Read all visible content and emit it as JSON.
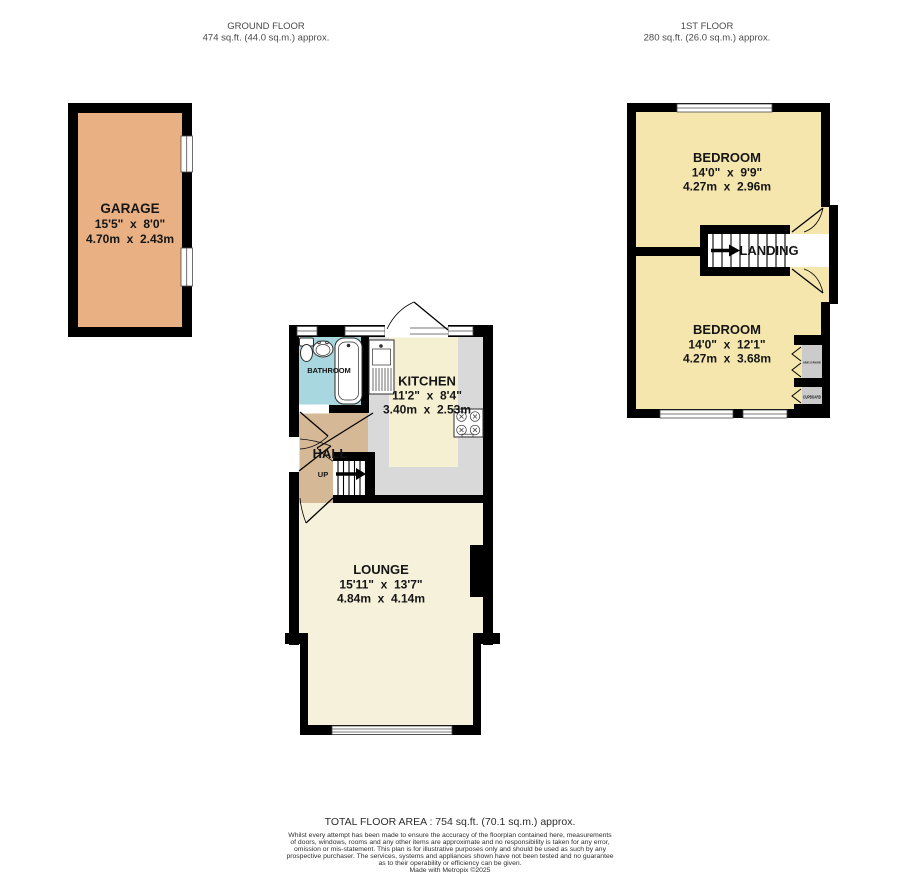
{
  "canvas": {
    "width": 900,
    "height": 874,
    "background": "#ffffff"
  },
  "floors": {
    "ground": {
      "title": "GROUND FLOOR",
      "area_label": "474 sq.ft. (44.0 sq.m.) approx."
    },
    "first": {
      "title": "1ST FLOOR",
      "area_label": "280 sq.ft. (26.0 sq.m.) approx."
    }
  },
  "rooms": {
    "garage": {
      "name": "GARAGE",
      "imperial": "15'5\"  x  8'0\"",
      "metric": "4.70m  x  2.43m",
      "fill": "#e9b183"
    },
    "bathroom": {
      "name": "BATHROOM",
      "fill": "#a9d7e0"
    },
    "kitchen": {
      "name": "KITCHEN",
      "imperial": "11'2\"  x  8'4\"",
      "metric": "3.40m  x  2.53m",
      "floor_fill": "#f6f0d3",
      "counter_fill": "#d9d9d9"
    },
    "hall": {
      "name": "HALL",
      "up_label": "UP",
      "fill": "#d5b895"
    },
    "lounge": {
      "name": "LOUNGE",
      "imperial": "15'11\"  x  13'7\"",
      "metric": "4.84m  x  4.14m",
      "fill": "#f6f1da"
    },
    "bedroom_front": {
      "name": "BEDROOM",
      "imperial": "14'0\"  x  9'9\"",
      "metric": "4.27m  x  2.96m",
      "fill": "#f5e6ae"
    },
    "bedroom_back": {
      "name": "BEDROOM",
      "imperial": "14'0\"  x  12'1\"",
      "metric": "4.27m  x  3.68m",
      "fill": "#f5e6ae"
    },
    "landing": {
      "name": "LANDING"
    },
    "airing_cupboard": {
      "name": "AIRING CUPBOARD",
      "fill": "#cbcbcb"
    },
    "cupboard": {
      "name": "CUPBOARD",
      "fill": "#cbcbcb"
    }
  },
  "footer": {
    "total": "TOTAL FLOOR AREA : 754 sq.ft. (70.1 sq.m.) approx.",
    "disclaimer": [
      "Whilst every attempt has been made to ensure the accuracy of the floorplan contained here, measurements",
      "of doors, windows, rooms and any other items are approximate and no responsibility is taken for any error,",
      "omission or mis-statement. This plan is for illustrative purposes only and should be used as such by any",
      "prospective purchaser. The services, systems and appliances shown have not been tested and no guarantee",
      "as to their operability or efficiency can be given."
    ],
    "credit": "Made with Metropix ©2025"
  },
  "palette": {
    "wall": "#000000",
    "window": "#ffffff"
  }
}
